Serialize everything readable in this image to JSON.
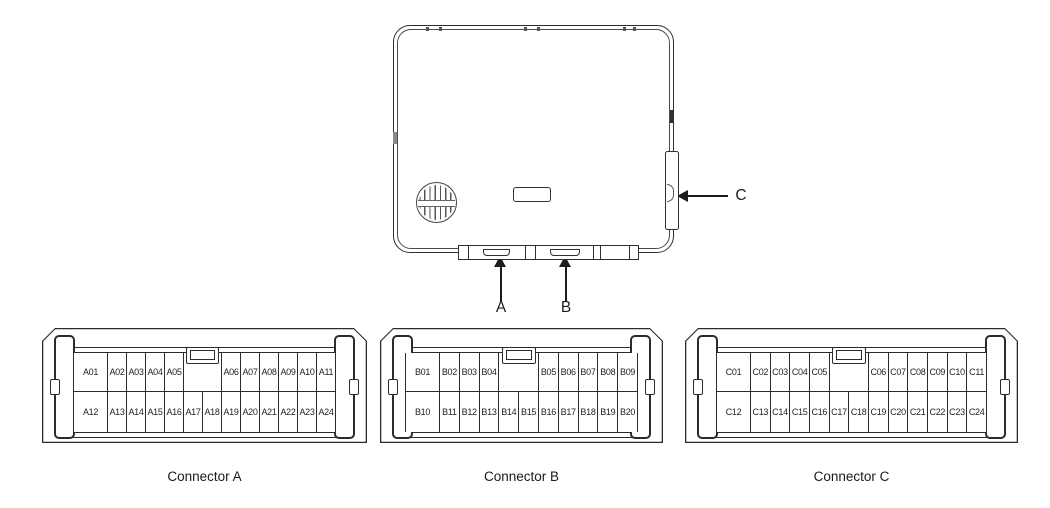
{
  "colors": {
    "line": "#2b2b2b",
    "background": "#ffffff"
  },
  "module": {
    "callouts": {
      "a": "A",
      "b": "B",
      "c": "C"
    }
  },
  "connectors": [
    {
      "caption": "Connector A",
      "pins": {
        "top": [
          "A01",
          "A02",
          "A03",
          "A04",
          "A05",
          "",
          "A06",
          "A07",
          "A08",
          "A09",
          "A10",
          "A11"
        ],
        "bottom": [
          "A12",
          "A13",
          "A14",
          "A15",
          "A16",
          "A17",
          "A18",
          "A19",
          "A20",
          "A21",
          "A22",
          "A23",
          "A24"
        ]
      }
    },
    {
      "caption": "Connector B",
      "pins": {
        "top": [
          "B01",
          "B02",
          "B03",
          "B04",
          "",
          "B05",
          "B06",
          "B07",
          "B08",
          "B09"
        ],
        "bottom": [
          "B10",
          "B11",
          "B12",
          "B13",
          "B14",
          "B15",
          "B16",
          "B17",
          "B18",
          "B19",
          "B20"
        ]
      }
    },
    {
      "caption": "Connector C",
      "pins": {
        "top": [
          "C01",
          "C02",
          "C03",
          "C04",
          "C05",
          "",
          "C06",
          "C07",
          "C08",
          "C09",
          "C10",
          "C11"
        ],
        "bottom": [
          "C12",
          "C13",
          "C14",
          "C15",
          "C16",
          "C17",
          "C18",
          "C19",
          "C20",
          "C21",
          "C22",
          "C23",
          "C24"
        ]
      }
    }
  ]
}
